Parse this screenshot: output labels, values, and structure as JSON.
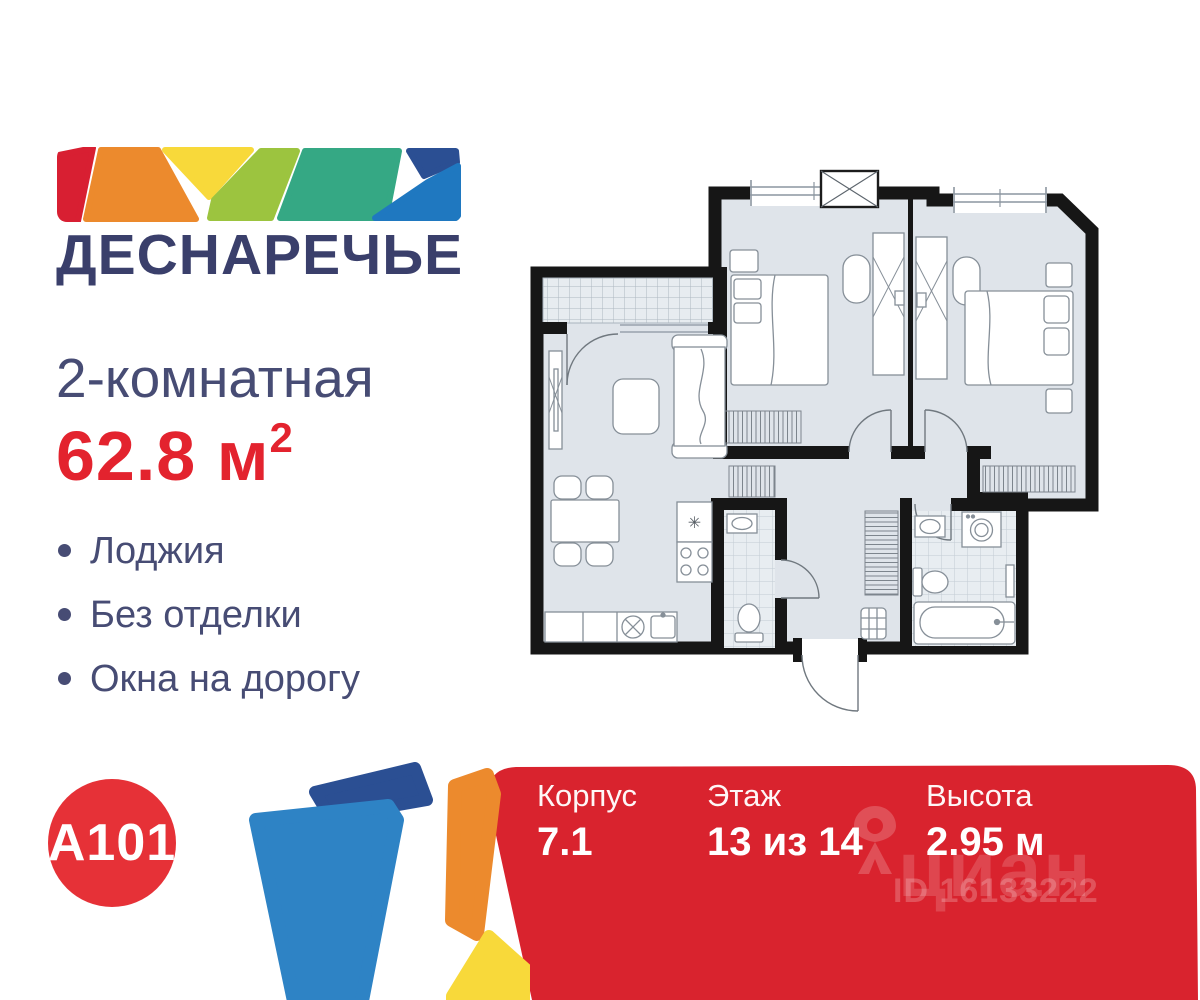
{
  "brand": {
    "project_name": "ДЕСНАРЕЧЬЕ",
    "developer_logo": "A101",
    "navy": "#3a3f6b",
    "accent_red": "#e3232e",
    "logo_mosaic_colors": [
      "#d81f32",
      "#ec8a2d",
      "#f8d93a",
      "#9cc43f",
      "#35a884",
      "#2b4f93",
      "#1f78c0"
    ]
  },
  "listing": {
    "rooms_title": "2-комнатная",
    "area_value": "62.8 м",
    "area_superscript": "2",
    "features": [
      "Лоджия",
      "Без отделки",
      "Окна на дорогу"
    ]
  },
  "banner": {
    "background": "#d9232e",
    "items": [
      {
        "label": "Корпус",
        "value": "7.1"
      },
      {
        "label": "Этаж",
        "value": "13 из 14"
      },
      {
        "label": "Высота",
        "value": "2.95 м"
      }
    ],
    "watermark": {
      "brand": "циан",
      "listing_id": "ID 16133222"
    }
  }
}
